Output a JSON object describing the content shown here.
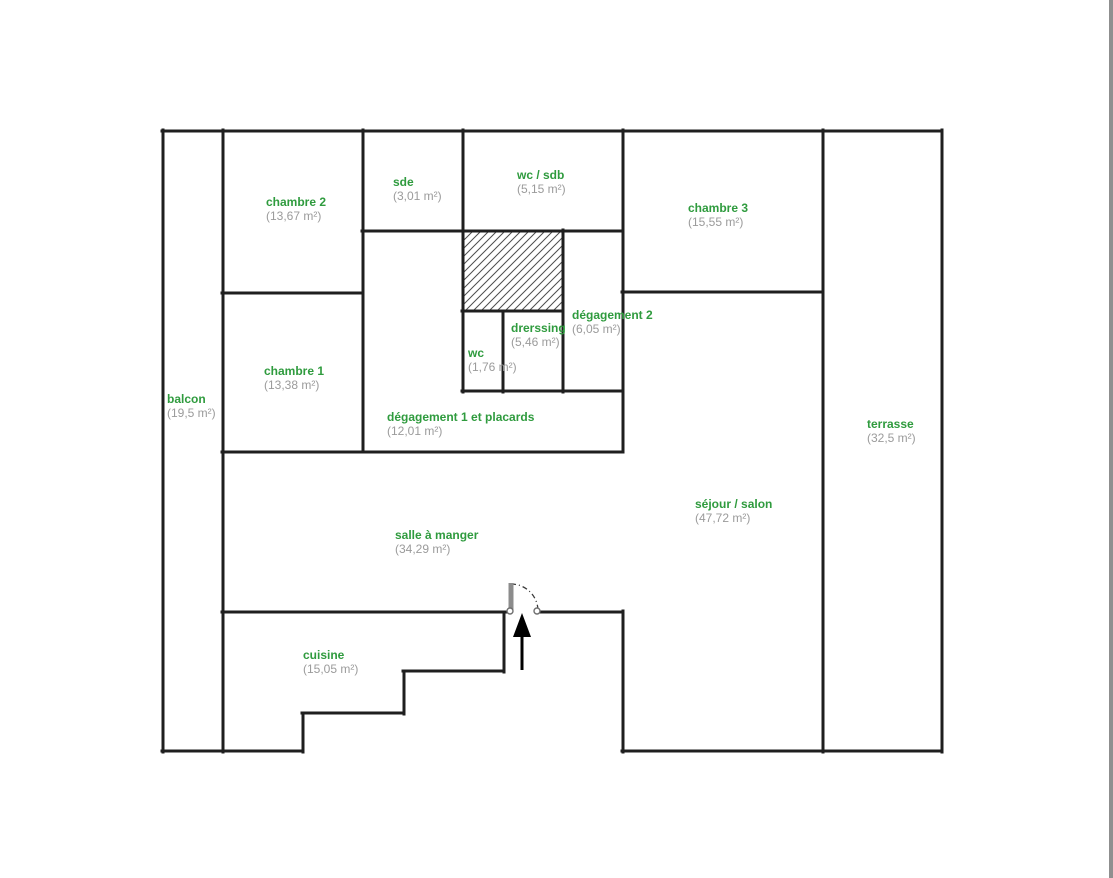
{
  "page": {
    "background": "#ffffff",
    "edge_strip_color": "#8f8f8f"
  },
  "colors": {
    "room_name_color": "#2f9b3e",
    "room_area_color": "#9b9b9b",
    "wall_color": "#1f1f1f",
    "door_leaf_color": "#8c8c8c",
    "hatch_color": "#4d4d4d",
    "edge_strip_color": "#8f8f8f",
    "page_bg": "#ffffff"
  },
  "symbols": {
    "entrance_arrow": "arrow-up-icon",
    "door": "door-swing-icon",
    "shaft": "hatched-area"
  },
  "rooms": [
    {
      "id": "balcon",
      "name": "balcon",
      "area": "(19,5 m²)"
    },
    {
      "id": "chambre-2",
      "name": "chambre 2",
      "area": "(13,67 m²)"
    },
    {
      "id": "sde",
      "name": "sde",
      "area": "(3,01 m²)"
    },
    {
      "id": "wc-sdb",
      "name": "wc / sdb",
      "area": "(5,15 m²)"
    },
    {
      "id": "chambre-3",
      "name": "chambre 3",
      "area": "(15,55 m²)"
    },
    {
      "id": "chambre-1",
      "name": "chambre 1",
      "area": "(13,38 m²)"
    },
    {
      "id": "wc",
      "name": "wc",
      "area": "(1,76 m²)"
    },
    {
      "id": "drerssing",
      "name": "drerssing",
      "area": "(5,46 m²)"
    },
    {
      "id": "degagement-2",
      "name": "dégagement 2",
      "area": "(6,05 m²)"
    },
    {
      "id": "degagement-1",
      "name": "dégagement 1 et placards",
      "area": "(12,01 m²)"
    },
    {
      "id": "terrasse",
      "name": "terrasse",
      "area": "(32,5 m²)"
    },
    {
      "id": "sejour-salon",
      "name": "séjour / salon",
      "area": "(47,72 m²)"
    },
    {
      "id": "salle-a-manger",
      "name": "salle à manger",
      "area": "(34,29 m²)"
    },
    {
      "id": "cuisine",
      "name": "cuisine",
      "area": "(15,05 m²)"
    }
  ]
}
